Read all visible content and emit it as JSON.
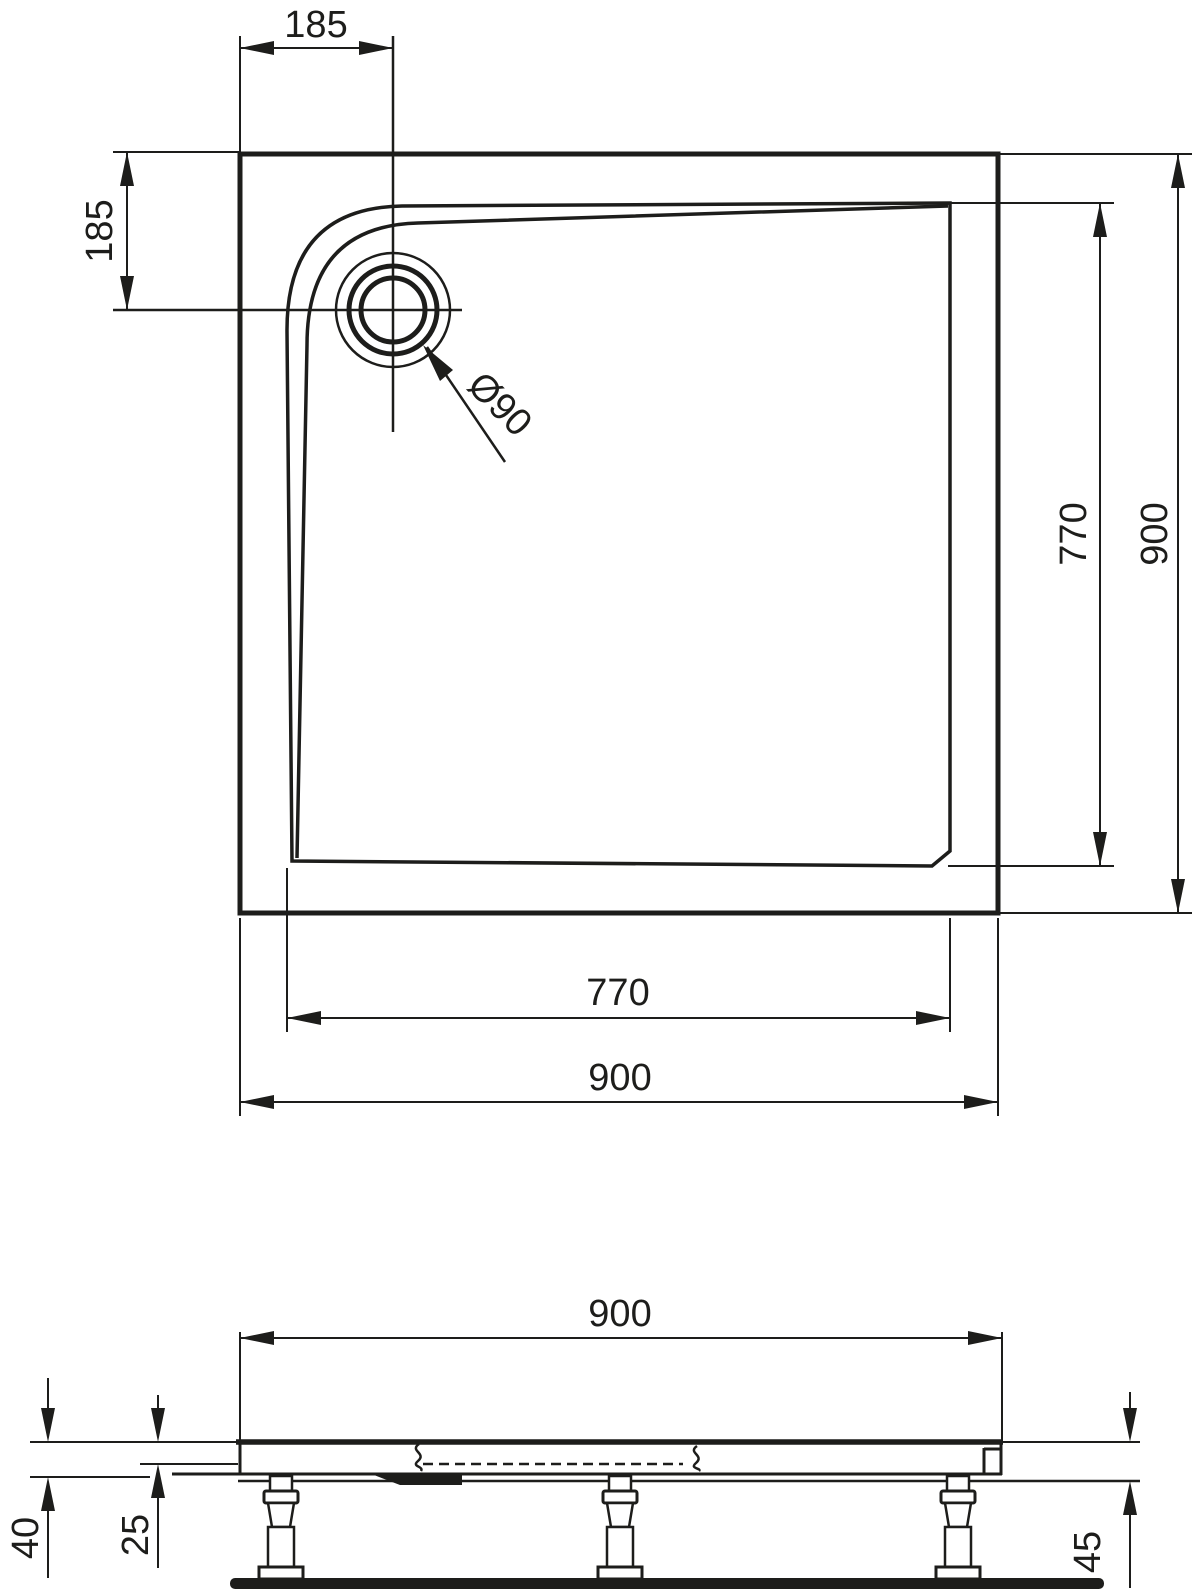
{
  "title": "Shower tray technical drawing",
  "colors": {
    "ink": "#1d1d1b",
    "background": "#ffffff"
  },
  "plan_view": {
    "dim_drain_offset_top": "185",
    "dim_drain_offset_left": "185",
    "drain_label": "Ø90",
    "dim_inner_height_right": "770",
    "dim_outer_height_right": "900",
    "dim_inner_width_bottom": "770",
    "dim_outer_width_bottom": "900"
  },
  "section_view": {
    "dim_width": "900",
    "dim_edge_height_left": "40",
    "dim_basin_depth_left": "25",
    "dim_total_height_right": "45"
  }
}
